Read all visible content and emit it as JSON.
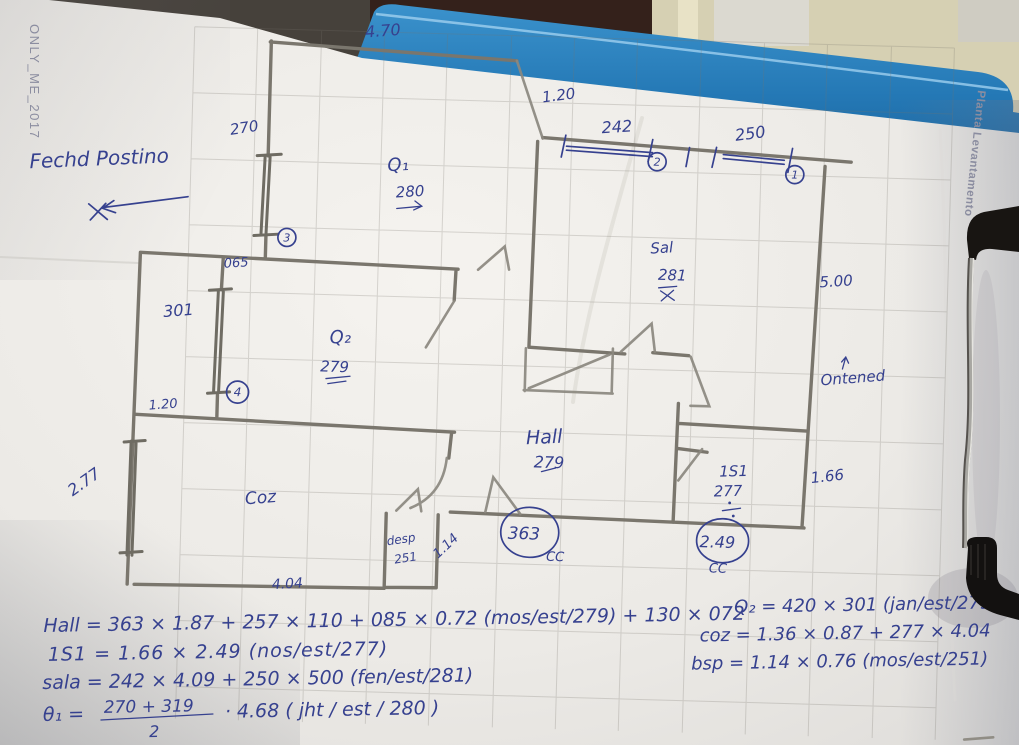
{
  "paper": {
    "watermark": "ONLY_ME_2017",
    "side_label": "Planta Levantamento"
  },
  "notes": {
    "facade": "Fechd Postino",
    "antenna": "Ontened"
  },
  "dims": {
    "top_width": "4.70",
    "back_window": "270",
    "top_opening": "1.20",
    "sala_window_left": "242",
    "sala_window_right": "250",
    "corridor_width": "065",
    "left_window_mid": "301",
    "left_opening": "1.20",
    "left_window_low": "2.77",
    "right_depth": "5.00",
    "right_width": "1.66",
    "desp_door": "1.14",
    "coz_width": "4.04"
  },
  "rooms": {
    "q1": {
      "name": "Q₁",
      "height": "280"
    },
    "q2": {
      "name": "Q₂",
      "height": "279"
    },
    "sala": {
      "name": "Sal",
      "height": "281"
    },
    "hall": {
      "name": "Hall",
      "height": "279"
    },
    "r1s1": {
      "name": "1S1",
      "height": "277"
    },
    "coz": {
      "name": "Coz"
    },
    "desp": {
      "name": "desp",
      "height": "251"
    }
  },
  "markers": {
    "c1": "1",
    "c2": "2",
    "c3": "3",
    "c4": "4",
    "cc_left": {
      "value": "363",
      "label": "CC"
    },
    "cc_right": {
      "value": "2.49",
      "label": "CC"
    }
  },
  "formulas": {
    "hall": "Hall = 363 × 1.87 + 257 × 110 + 085 × 0.72 (mos/est/279) + 130 × 072",
    "r1s1": "1S1 = 1.66 × 2.49 (nos/est/277)",
    "sala": "sala = 242 × 4.09 + 250 × 500 (fen/est/281)",
    "theta1_lhs": "θ₁ =",
    "theta1_num": "270 + 319",
    "theta1_den": "2",
    "theta1_rhs": "· 4.68  ( jht / est / 280 )",
    "q2": "Q₂ = 420 × 301 (jan/est/279)",
    "coz": "coz = 1.36 × 0.87 + 277 × 4.04",
    "bsp": "bsp = 1.14 × 0.76 (mos/est/251)"
  }
}
